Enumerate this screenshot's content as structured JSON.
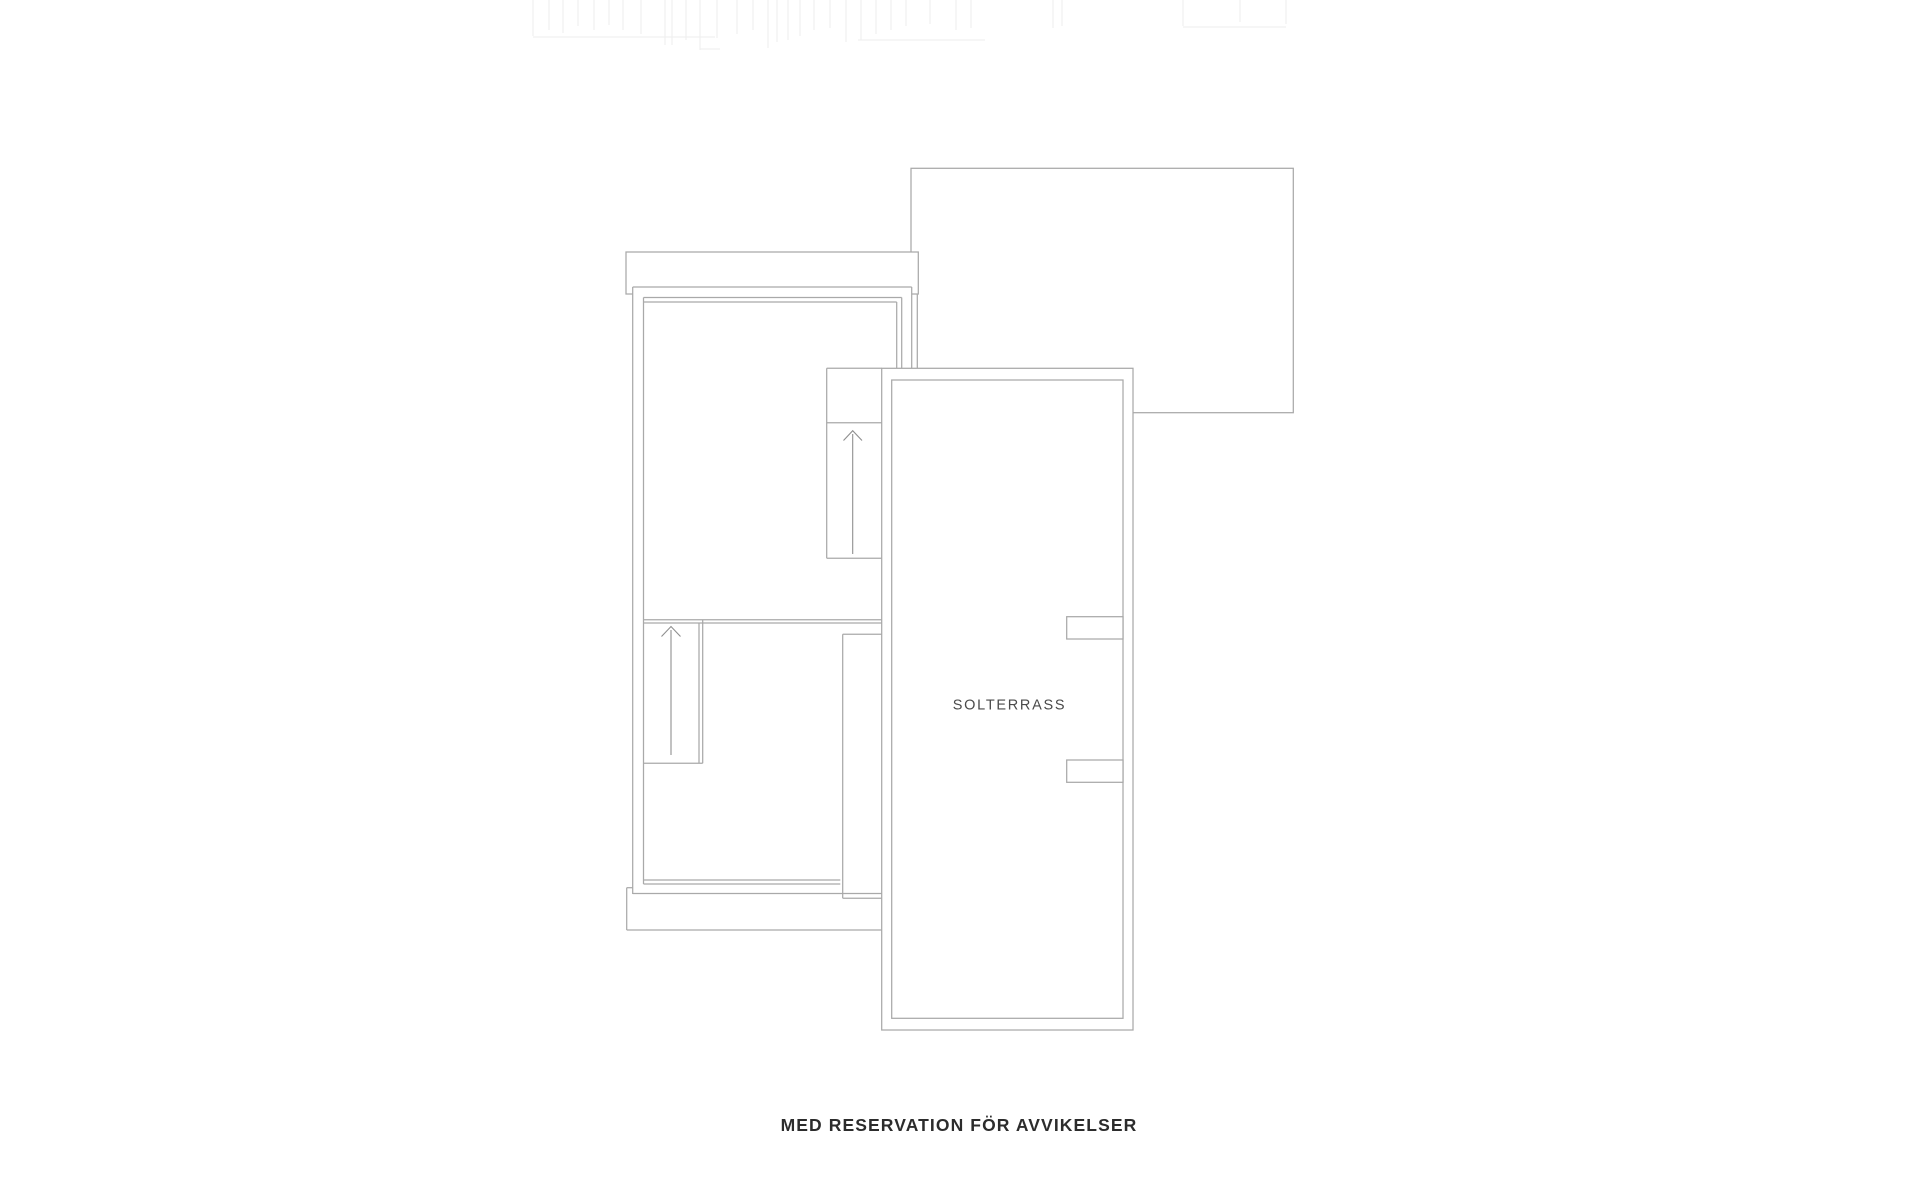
{
  "labels": {
    "room_label": "SOLTERRASS",
    "disclaimer": "MED RESERVATION FÖR AVVIKELSER"
  },
  "colors": {
    "background": "#ffffff",
    "line": "#a9a9a9",
    "arrow": "#8f8f8f",
    "ghost": "#f0f0f0",
    "room_label_text": "#4a4a4a",
    "disclaimer_text": "#2c2c2c",
    "white_fill": "#ffffff"
  },
  "floorplan": {
    "ghost_vertical_lines": [
      [
        533,
        36
      ],
      [
        549,
        30
      ],
      [
        563,
        33
      ],
      [
        578,
        26
      ],
      [
        594,
        30
      ],
      [
        609,
        25
      ],
      [
        623,
        30
      ],
      [
        641,
        34
      ],
      [
        665,
        45
      ],
      [
        672,
        45
      ],
      [
        686,
        40
      ],
      [
        700,
        50
      ],
      [
        717,
        38
      ],
      [
        737,
        34
      ],
      [
        753,
        30
      ],
      [
        768,
        48
      ],
      [
        777,
        42
      ],
      [
        788,
        40
      ],
      [
        800,
        36
      ],
      [
        814,
        30
      ],
      [
        830,
        28
      ],
      [
        846,
        42
      ],
      [
        861,
        40
      ],
      [
        876,
        34
      ],
      [
        891,
        30
      ],
      [
        906,
        26
      ],
      [
        930,
        24
      ],
      [
        956,
        30
      ],
      [
        971,
        28
      ],
      [
        1053,
        28
      ],
      [
        1062,
        26
      ],
      [
        1183,
        26
      ],
      [
        1240,
        22
      ],
      [
        1286,
        24
      ]
    ],
    "ghost_horizontal_lines": [
      [
        533,
        715,
        37
      ],
      [
        858,
        985,
        40
      ],
      [
        1183,
        1286,
        27
      ],
      [
        700,
        720,
        49
      ]
    ],
    "elements": [
      {
        "t": "rect",
        "x": 911,
        "y": 168.3,
        "w": 382.3,
        "h": 244.4,
        "fill": false,
        "stroke": true,
        "name": "upper-roof-outline"
      },
      {
        "t": "rect",
        "x": 626,
        "y": 252,
        "w": 292.3,
        "h": 42,
        "fill": true,
        "stroke": true,
        "name": "top-balcony-strip"
      },
      {
        "t": "poly",
        "pts": "632.7,287 911.7,287 911.7,368.3 881.7,368.3 881.7,930 626.7,930 626.7,887.7 632.7,887.7",
        "fill": true,
        "stroke": false,
        "name": "house-body-fill"
      },
      {
        "t": "rect",
        "x": 881.7,
        "y": 368.3,
        "w": 251.3,
        "h": 661.7,
        "fill": true,
        "stroke": true,
        "name": "solterrass-outer"
      },
      {
        "t": "rect",
        "x": 891.7,
        "y": 380,
        "w": 231.3,
        "h": 638.3,
        "fill": false,
        "stroke": true,
        "name": "solterrass-inner"
      },
      {
        "t": "line",
        "x1": 632.7,
        "y1": 287,
        "x2": 632.7,
        "y2": 894,
        "name": "left-outer-wall"
      },
      {
        "t": "line",
        "x1": 643.5,
        "y1": 297.5,
        "x2": 643.5,
        "y2": 884,
        "name": "left-inner-wall"
      },
      {
        "t": "line",
        "x1": 632.7,
        "y1": 287,
        "x2": 911.7,
        "y2": 287,
        "name": "top-outer-wall"
      },
      {
        "t": "line",
        "x1": 643.5,
        "y1": 297.5,
        "x2": 901.7,
        "y2": 297.5,
        "name": "top-window-line-1"
      },
      {
        "t": "line",
        "x1": 643.5,
        "y1": 302,
        "x2": 896.7,
        "y2": 302,
        "name": "top-window-line-2"
      },
      {
        "t": "line",
        "x1": 901.7,
        "y1": 297.5,
        "x2": 901.7,
        "y2": 368.3,
        "name": "right-window-line-1"
      },
      {
        "t": "line",
        "x1": 896.7,
        "y1": 302,
        "x2": 896.7,
        "y2": 368.3,
        "name": "right-window-line-2"
      },
      {
        "t": "line",
        "x1": 911.7,
        "y1": 287,
        "x2": 911.7,
        "y2": 368.3,
        "name": "right-outer-wall"
      },
      {
        "t": "line",
        "x1": 917.3,
        "y1": 294,
        "x2": 917.3,
        "y2": 368.3,
        "name": "right-wall-extra"
      },
      {
        "t": "line",
        "x1": 643.5,
        "y1": 619.7,
        "x2": 881.7,
        "y2": 619.7,
        "name": "mid-divider-1"
      },
      {
        "t": "line",
        "x1": 643.5,
        "y1": 623,
        "x2": 881.7,
        "y2": 623,
        "name": "mid-divider-2"
      },
      {
        "t": "line",
        "x1": 643.5,
        "y1": 880,
        "x2": 840.3,
        "y2": 880,
        "name": "bottom-window-line-1"
      },
      {
        "t": "line",
        "x1": 643.5,
        "y1": 884,
        "x2": 840.3,
        "y2": 884,
        "name": "bottom-window-line-2"
      },
      {
        "t": "line",
        "x1": 632.7,
        "y1": 893.5,
        "x2": 881.7,
        "y2": 893.5,
        "name": "bottom-outer-wall"
      },
      {
        "t": "line",
        "x1": 826.7,
        "y1": 368.3,
        "x2": 826.7,
        "y2": 558.3,
        "name": "stair1-left"
      },
      {
        "t": "line",
        "x1": 826.7,
        "y1": 368.3,
        "x2": 881.7,
        "y2": 368.3,
        "name": "stair1-top"
      },
      {
        "t": "line",
        "x1": 826.7,
        "y1": 422.7,
        "x2": 881.7,
        "y2": 422.7,
        "name": "stair1-landing"
      },
      {
        "t": "line",
        "x1": 826.7,
        "y1": 558.3,
        "x2": 881.7,
        "y2": 558.3,
        "name": "stair1-bottom"
      },
      {
        "t": "line",
        "x1": 702.7,
        "y1": 619.7,
        "x2": 702.7,
        "y2": 763.3,
        "name": "stair2-right-outer"
      },
      {
        "t": "line",
        "x1": 699,
        "y1": 623,
        "x2": 699,
        "y2": 763.3,
        "name": "stair2-right-inner"
      },
      {
        "t": "line",
        "x1": 643.5,
        "y1": 763.3,
        "x2": 702.7,
        "y2": 763.3,
        "name": "stair2-bottom"
      },
      {
        "t": "line",
        "x1": 842.7,
        "y1": 634.3,
        "x2": 842.7,
        "y2": 898.3,
        "name": "shaft-left"
      },
      {
        "t": "line",
        "x1": 842.7,
        "y1": 634.3,
        "x2": 881.7,
        "y2": 634.3,
        "name": "shaft-top"
      },
      {
        "t": "line",
        "x1": 842.7,
        "y1": 898.3,
        "x2": 881.7,
        "y2": 898.3,
        "name": "shaft-bottom"
      },
      {
        "t": "line",
        "x1": 626.7,
        "y1": 887.7,
        "x2": 626.7,
        "y2": 930,
        "name": "bottom-strip-left"
      },
      {
        "t": "line",
        "x1": 626.7,
        "y1": 887.7,
        "x2": 633,
        "y2": 887.7,
        "name": "bottom-strip-notch"
      },
      {
        "t": "line",
        "x1": 626.7,
        "y1": 930,
        "x2": 881.7,
        "y2": 930,
        "name": "bottom-strip-bottom"
      },
      {
        "t": "rect",
        "x": 1066.7,
        "y": 616.7,
        "w": 56.3,
        "h": 22.3,
        "fill": true,
        "stroke": true,
        "name": "terrace-pillar-upper"
      },
      {
        "t": "rect",
        "x": 1066.7,
        "y": 760,
        "w": 56.3,
        "h": 22.3,
        "fill": true,
        "stroke": true,
        "name": "terrace-pillar-lower"
      }
    ],
    "arrows": [
      {
        "shaft": [
          852.7,
          434,
          852.7,
          554
        ],
        "head": "843.5,440.5 852.7,430.7 862,440.5",
        "name": "stair1-direction-arrow"
      },
      {
        "shaft": [
          671,
          630,
          671,
          755
        ],
        "head": "661.5,636.5 671,626.5 680.5,636.5",
        "name": "stair2-direction-arrow"
      }
    ]
  }
}
